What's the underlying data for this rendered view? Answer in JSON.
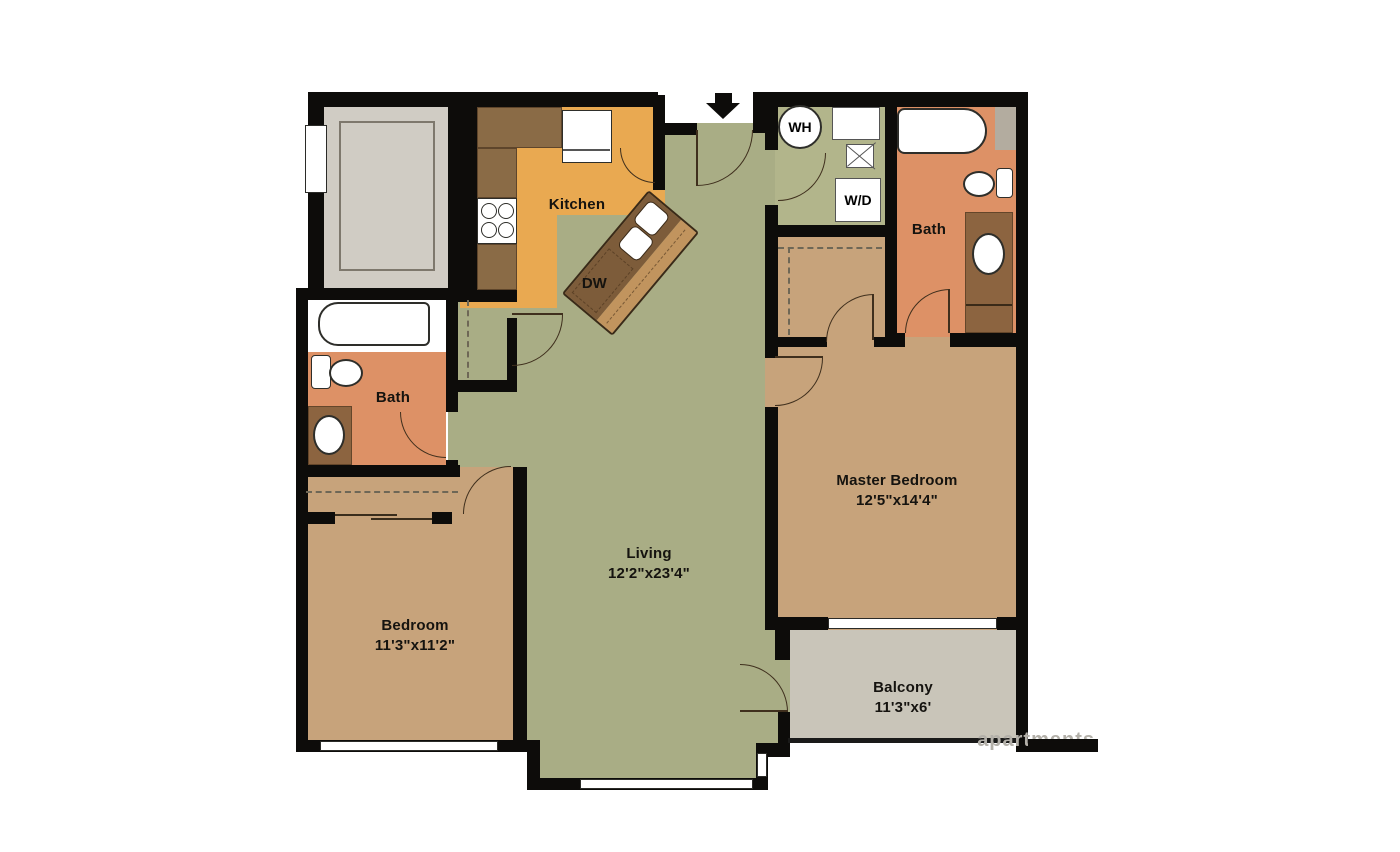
{
  "plan": {
    "rooms": {
      "kitchen": {
        "label": "Kitchen"
      },
      "living": {
        "label": "Living",
        "dims": "12'2\"x23'4\""
      },
      "bedroom": {
        "label": "Bedroom",
        "dims": "11'3\"x11'2\""
      },
      "master_bedroom": {
        "label": "Master Bedroom",
        "dims": "12'5\"x14'4\""
      },
      "bath_left": {
        "label": "Bath"
      },
      "bath_right": {
        "label": "Bath"
      },
      "balcony": {
        "label": "Balcony",
        "dims": "11'3\"x6'"
      }
    },
    "appliances": {
      "dishwasher": "DW",
      "water_heater": "WH",
      "washer_dryer": "W/D"
    },
    "watermark": "apartments",
    "colors": {
      "wall": "#0d0c0a",
      "living_floor": "#a9ad85",
      "laundry_floor": "#b2b58b",
      "kitchen_floor": "#e9a951",
      "bedroom_floor": "#c7a37b",
      "bath_floor": "#dd9166",
      "balcony_floor": "#c9c5b9",
      "counter": "#8a6b46",
      "island": "#7d5c3a",
      "island_top": "#c1945e",
      "vanity": "#8c6440",
      "utility_floor": "#d0ccc4"
    }
  }
}
